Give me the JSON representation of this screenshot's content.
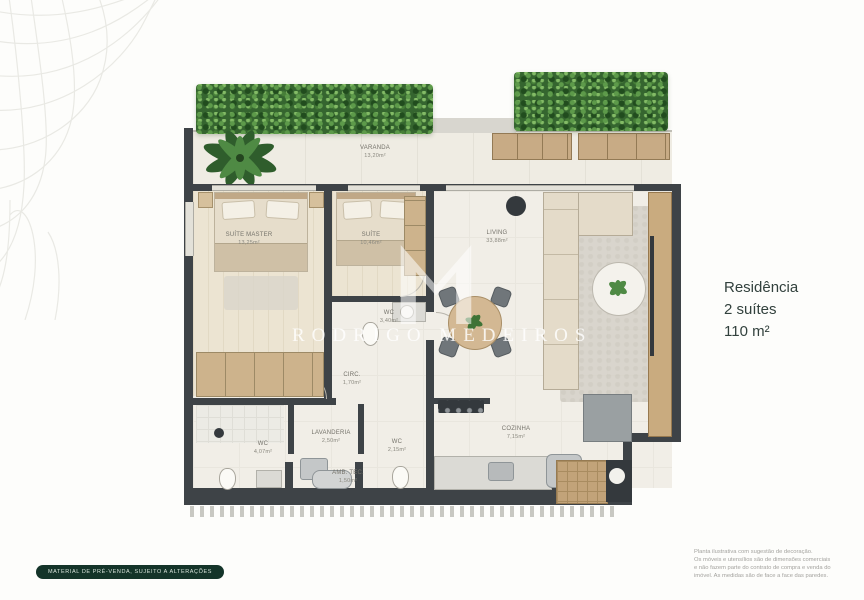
{
  "plan": {
    "watermark": {
      "name": "RODRIGO MEDEIROS",
      "logo": "m-monogram"
    },
    "rooms": [
      {
        "id": "varanda",
        "label": "VARANDA",
        "area": "13,20m²"
      },
      {
        "id": "suite-master",
        "label": "SUÍTE MASTER",
        "area": "13,25m²"
      },
      {
        "id": "suite",
        "label": "SUÍTE",
        "area": "10,46m²"
      },
      {
        "id": "living",
        "label": "LIVING",
        "area": "33,88m²"
      },
      {
        "id": "wc-suites",
        "label": "WC",
        "area": "3,40m²"
      },
      {
        "id": "circ",
        "label": "CIRC.",
        "area": "1,70m²"
      },
      {
        "id": "wc-master",
        "label": "WC",
        "area": "4,07m²"
      },
      {
        "id": "lavanderia",
        "label": "LAVANDERIA",
        "area": "2,50m²"
      },
      {
        "id": "amb-tec",
        "label": "AMB. TEC.",
        "area": "1,50m²"
      },
      {
        "id": "wc-social",
        "label": "WC",
        "area": "2,15m²"
      },
      {
        "id": "cozinha",
        "label": "COZINHA",
        "area": "7,15m²"
      }
    ],
    "colors": {
      "wall": "#3e4347",
      "floor": "#f1eee7",
      "wood": "#c9ab7f",
      "hedge": "#35652f",
      "brand": "#143429"
    }
  },
  "info_panel": {
    "line1": "Residência",
    "line2": "2 suítes",
    "line3": "110 m²"
  },
  "footer": {
    "badge": "MATERIAL DE PRÉ-VENDA, SUJEITO A ALTERAÇÕES",
    "disclaimer_lines": [
      "Planta ilustrativa com sugestão de decoração.",
      "Os móveis e utensílios são de dimensões comerciais",
      "e não fazem parte do contrato de compra e venda do",
      "imóvel. As medidas são de face a face das paredes."
    ]
  }
}
